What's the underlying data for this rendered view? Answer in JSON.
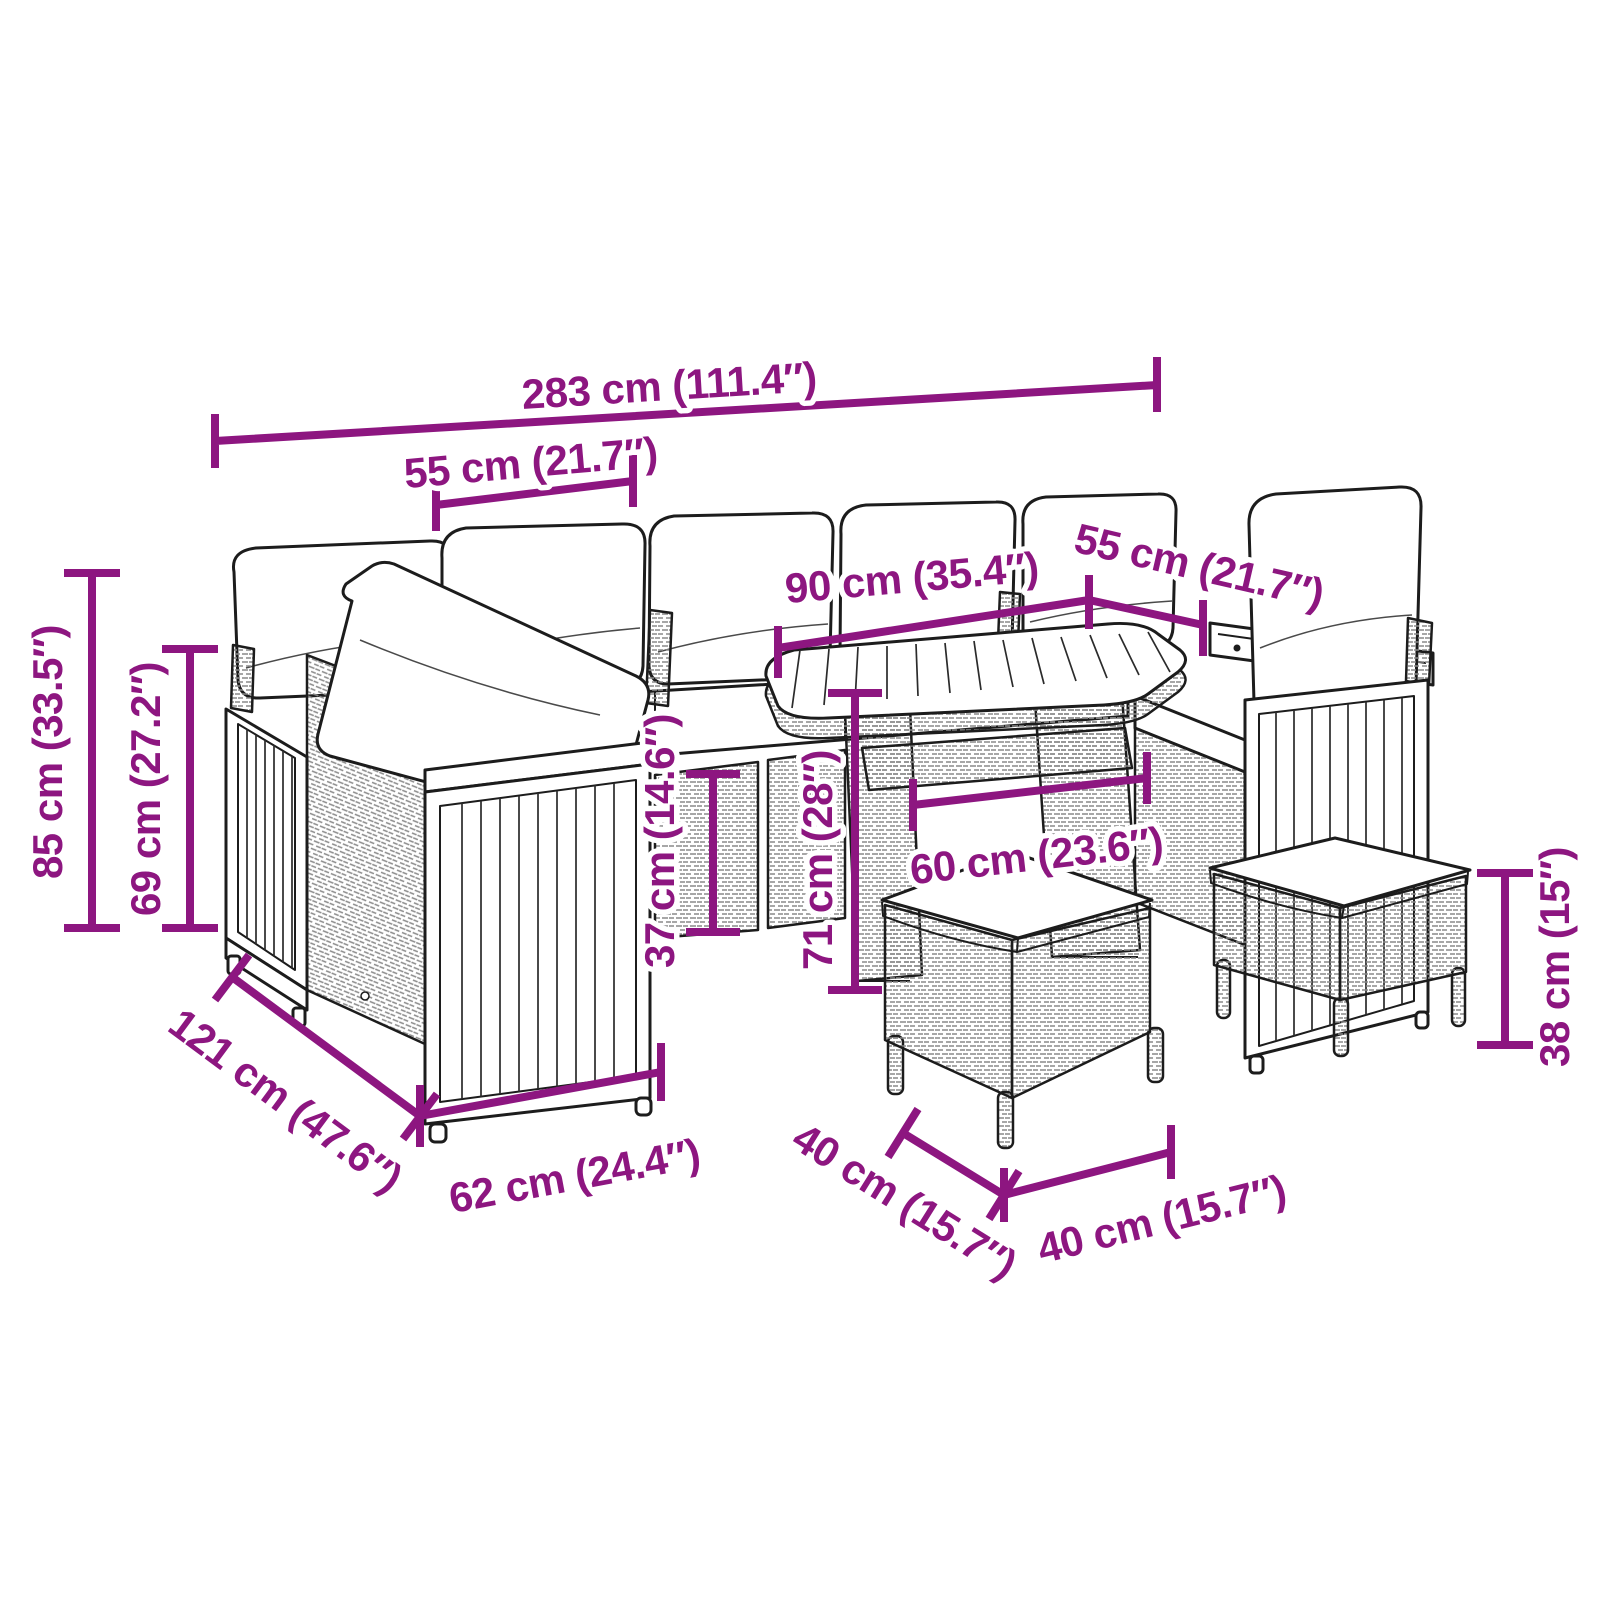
{
  "diagram": {
    "background": "#ffffff",
    "accent_color": "#8D1680",
    "outline_color": "#1c1c1c",
    "subject": "garden-lounge-set-dimension-diagram",
    "annotations": {
      "total_width": "283 cm (111.4″)",
      "module_width_left": "55 cm (21.7″)",
      "table_length": "90 cm (35.4″)",
      "module_width_right": "55 cm (21.7″)",
      "total_height": "85 cm (33.5″)",
      "backrest_height": "69 cm (27.2″)",
      "seat_height": "37 cm (14.6″)",
      "table_height": "71 cm (28″)",
      "table_width": "60 cm (23.6″)",
      "sofa_depth": "121 cm (47.6″)",
      "module_depth": "62 cm (24.4″)",
      "stool_depth": "40 cm (15.7″)",
      "stool_width": "40 cm (15.7″)",
      "stool_height": "38 cm (15″)"
    }
  }
}
